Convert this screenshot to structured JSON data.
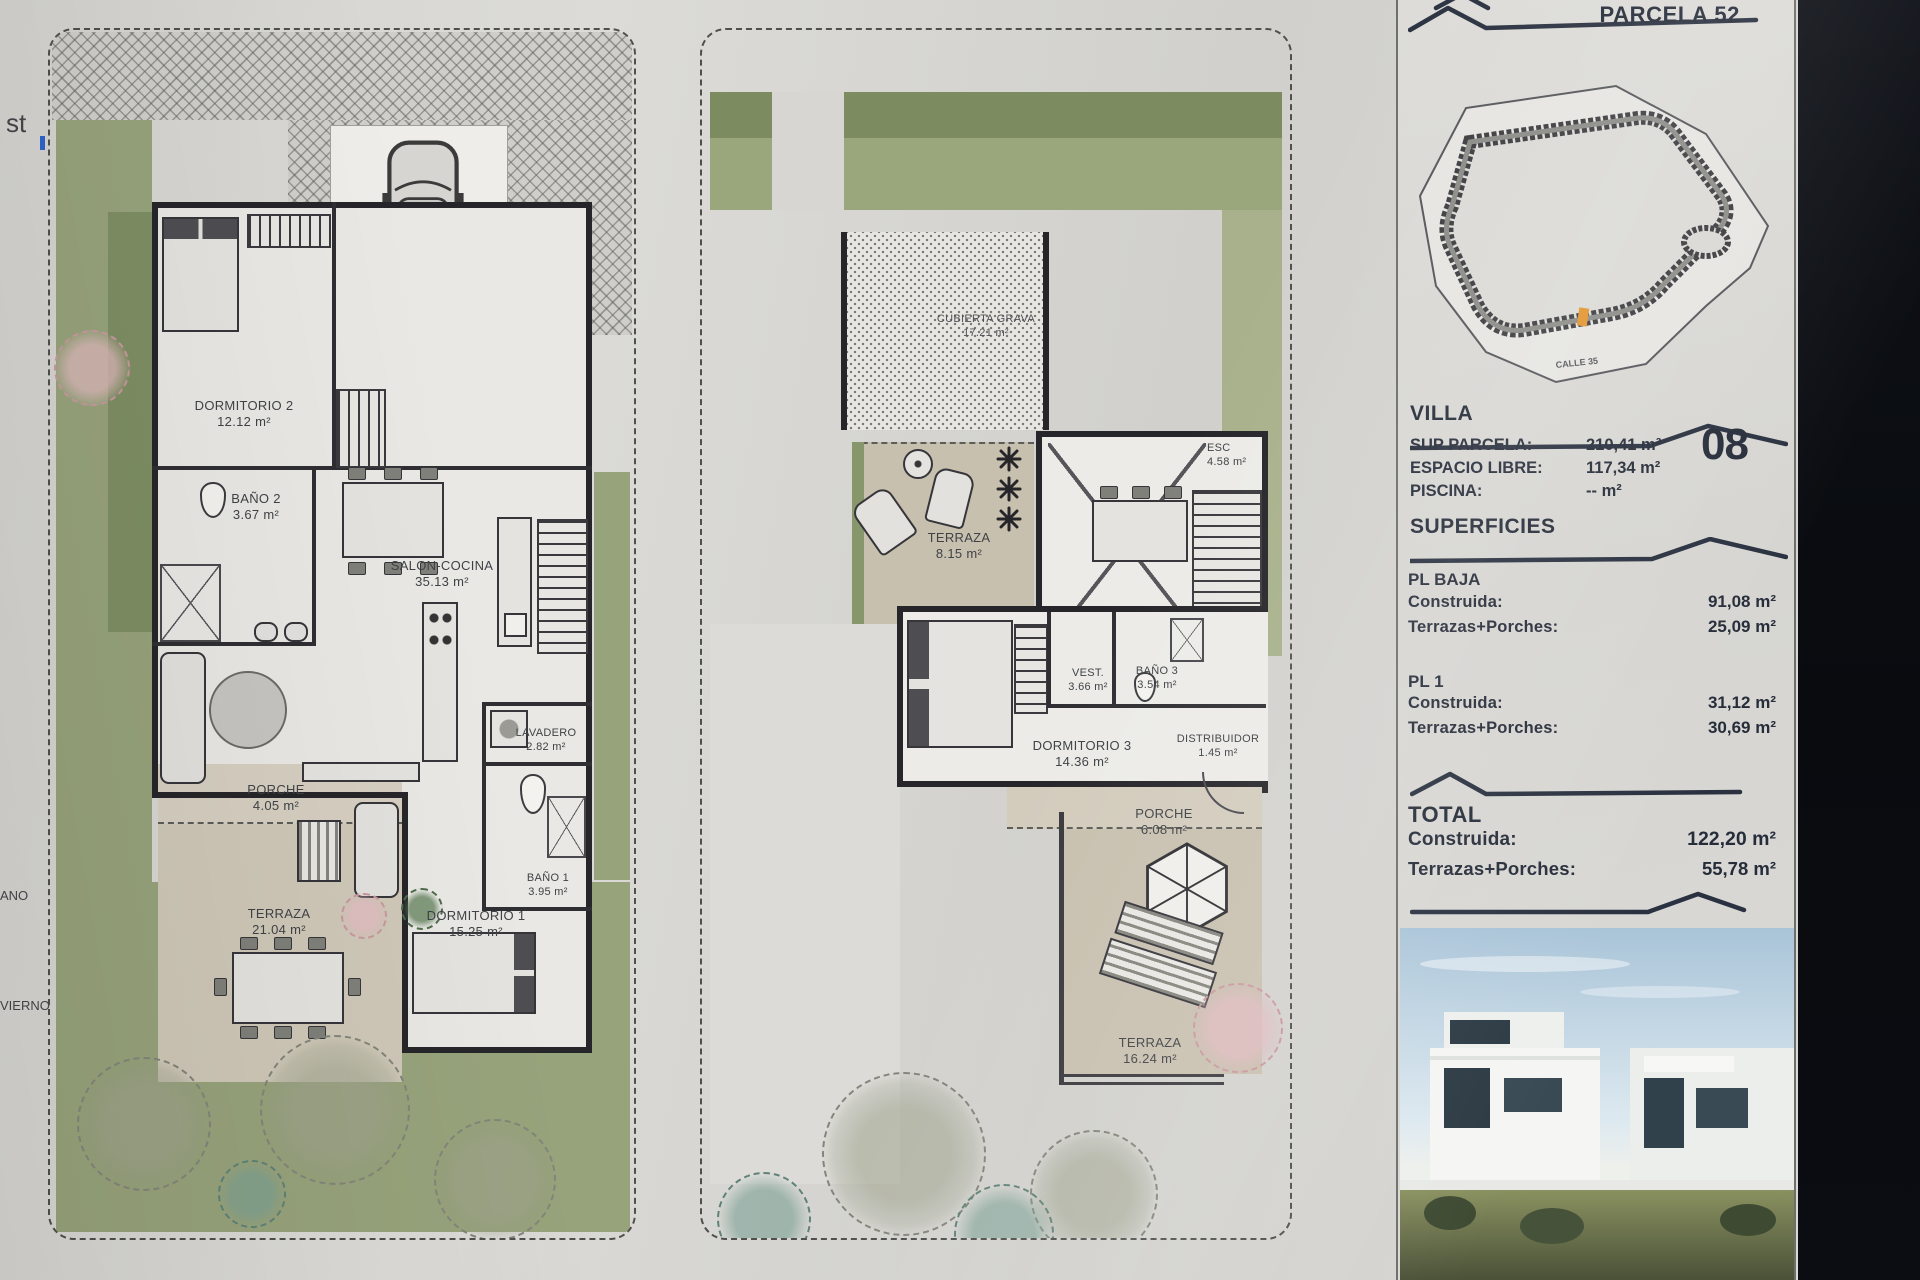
{
  "sheet": {
    "edge_fragments": [
      "st",
      "ANO",
      "VIERNO"
    ]
  },
  "plan_ground": {
    "rooms": [
      {
        "name": "DORMITORIO 2",
        "area": "12.12 m²"
      },
      {
        "name": "BAÑO 2",
        "area": "3.67 m²"
      },
      {
        "name": "SALON-COCINA",
        "area": "35.13 m²"
      },
      {
        "name": "LAVADERO",
        "area": "2.82 m²"
      },
      {
        "name": "BAÑO 1",
        "area": "3.95 m²"
      },
      {
        "name": "DORMITORIO 1",
        "area": "15.25 m²"
      },
      {
        "name": "PORCHE",
        "area": "4.05 m²"
      },
      {
        "name": "TERRAZA",
        "area": "21.04 m²"
      }
    ]
  },
  "plan_first": {
    "rooms": [
      {
        "name": "CUBIERTA GRAVA",
        "area": "17.21 m²"
      },
      {
        "name": "TERRAZA",
        "area": "8.15 m²"
      },
      {
        "name": "ESC",
        "area": "4.58 m²"
      },
      {
        "name": "VEST.",
        "area": "3.66 m²"
      },
      {
        "name": "BAÑO 3",
        "area": "3.54 m²"
      },
      {
        "name": "DORMITORIO 3",
        "area": "14.36 m²"
      },
      {
        "name": "DISTRIBUIDOR",
        "area": "1.45 m²"
      },
      {
        "name": "PORCHE",
        "area": "6.08 m²"
      },
      {
        "name": "TERRAZA",
        "area": "16.24 m²"
      }
    ]
  },
  "panel": {
    "parcel_title": "PARCELA 52",
    "map_street_label": "CALLE 35",
    "villa": {
      "heading": "VILLA",
      "number": "08",
      "rows": [
        {
          "label": "SUP PARCELA:",
          "value": "210,41 m²"
        },
        {
          "label": "ESPACIO LIBRE:",
          "value": "117,34 m²"
        },
        {
          "label": "PISCINA:",
          "value": "-- m²"
        }
      ]
    },
    "superficies": {
      "heading": "SUPERFICIES",
      "groups": [
        {
          "title": "PL BAJA",
          "rows": [
            {
              "label": "Construida:",
              "value": "91,08 m²"
            },
            {
              "label": "Terrazas+Porches:",
              "value": "25,09 m²"
            }
          ]
        },
        {
          "title": "PL 1",
          "rows": [
            {
              "label": "Construida:",
              "value": "31,12 m²"
            },
            {
              "label": "Terrazas+Porches:",
              "value": "30,69 m²"
            }
          ]
        }
      ]
    },
    "total": {
      "title": "TOTAL",
      "rows": [
        {
          "label": "Construida:",
          "value": "122,20 m²"
        },
        {
          "label": "Terrazas+Porches:",
          "value": "55,78 m²"
        }
      ]
    }
  }
}
